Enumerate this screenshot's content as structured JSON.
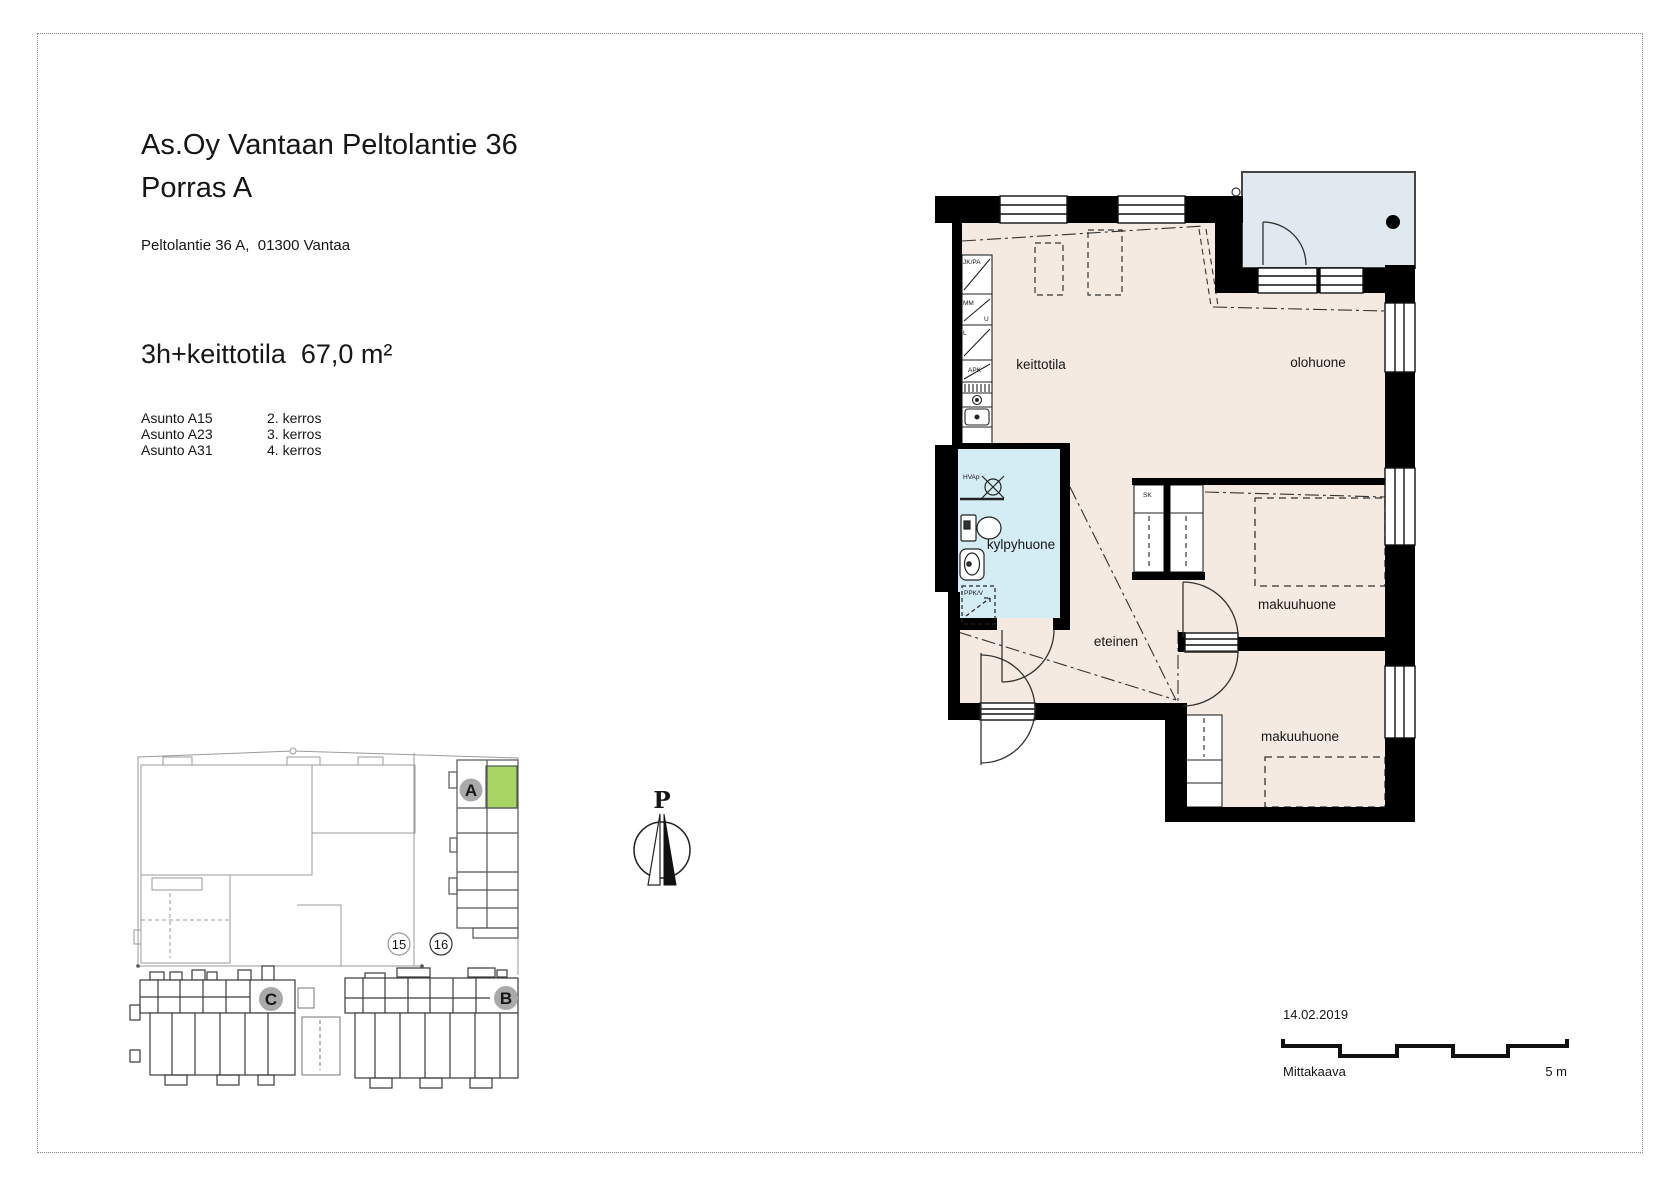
{
  "header": {
    "title_line1": "As.Oy Vantaan Peltolantie 36",
    "title_line2": "Porras A",
    "address": "Peltolantie 36 A,  01300 Vantaa",
    "apartment_type": "3h+keittotila  67,0 m²",
    "apartments": [
      {
        "name": "Asunto A15",
        "floor": "2. kerros"
      },
      {
        "name": "Asunto A23",
        "floor": "3. kerros"
      },
      {
        "name": "Asunto A31",
        "floor": "4. kerros"
      }
    ]
  },
  "floorplan": {
    "rooms": {
      "keittotila": "keittotila",
      "olohuone": "olohuone",
      "kylpyhuone": "kylpyhuone",
      "eteinen": "eteinen",
      "makuuhuone_1": "makuuhuone",
      "makuuhuone_2": "makuuhuone"
    },
    "fixture_labels": {
      "fridge_freezer": "JK/PA",
      "microwave": "MM",
      "oven": "U",
      "stove": "L",
      "dishwasher": "APK",
      "closet": "SK",
      "washer_reservation": "PPK/V",
      "shower_valve": "HVAp"
    },
    "colors": {
      "floor": "#f5eae1",
      "wet_room": "#d4ecf4",
      "balcony": "#dfe9ef",
      "wall": "#000000"
    }
  },
  "siteplan": {
    "buildings": [
      {
        "label": "A"
      },
      {
        "label": "B"
      },
      {
        "label": "C"
      }
    ],
    "plot_numbers": [
      "15",
      "16"
    ],
    "highlight_color": "#a9d565",
    "badge_color": "#a9a9a9"
  },
  "compass": {
    "north_label": "P"
  },
  "footer": {
    "date": "14.02.2019",
    "scale_label": "Mittakaava",
    "scale_max": "5 m"
  }
}
